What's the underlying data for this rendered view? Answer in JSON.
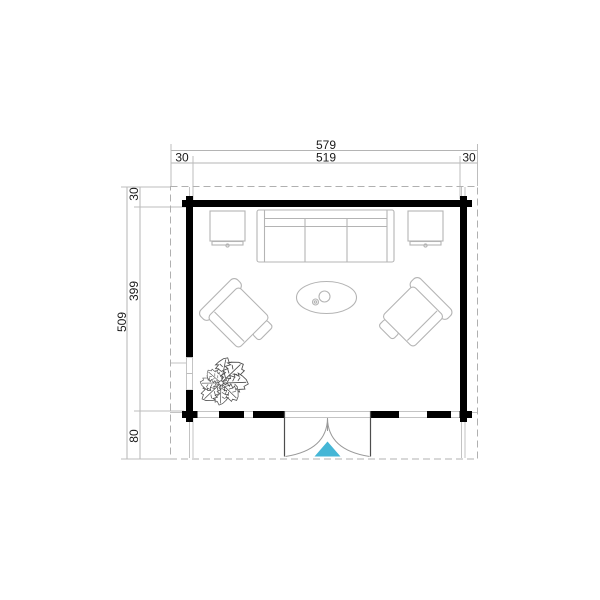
{
  "page": {
    "title": "Log cabin floor plan"
  },
  "colors": {
    "wall": "#000000",
    "furniture_line": "#b4b4b4",
    "dimension_line": "#b4b4b4",
    "dimension_text": "#1a1a1a",
    "roof_overhang_dash": "#b0b0b0",
    "door_arc": "#999999",
    "plant_line": "#4d4d4d",
    "door_arrow": "#45b6d6"
  },
  "dimensions": {
    "top": {
      "overall": "579",
      "left_offset": "30",
      "inner": "519",
      "right_offset": "30"
    },
    "side": {
      "overall": "509",
      "top_offset": "30",
      "inner": "399",
      "bottom_offset": "80"
    }
  },
  "symbols": {
    "sofa": "three-seat-sofa",
    "side_table_left": "side-table",
    "side_table_right": "side-table",
    "armchair_left": "armchair",
    "armchair_right": "armchair",
    "coffee_table": "oval-coffee-table",
    "plant": "potted-plant",
    "door": "double-swing-entrance-door"
  }
}
